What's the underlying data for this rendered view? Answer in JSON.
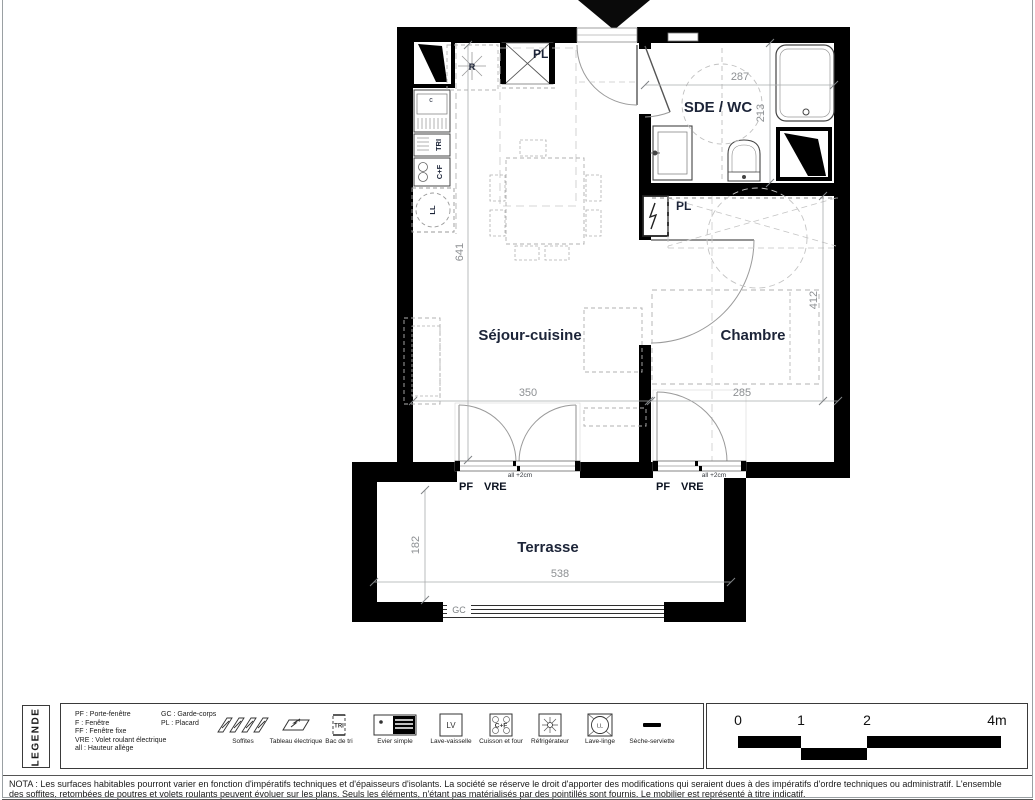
{
  "plan": {
    "rooms": {
      "sejour": {
        "label": "Séjour-cuisine",
        "dim_h": "641",
        "dim_w": "350"
      },
      "chambre": {
        "label": "Chambre",
        "dim_h": "412",
        "dim_w": "285"
      },
      "sde": {
        "label": "SDE / WC",
        "dim_w": "287",
        "dim_h": "213"
      },
      "terrasse": {
        "label": "Terrasse",
        "dim_h": "182",
        "dim_w": "538"
      }
    },
    "fixtures": {
      "refrigerateur": "R",
      "placard_entree": "PL",
      "placard_chambre": "PL",
      "bac_tri": "TRI",
      "cuisson_four": "C+F",
      "lave_linge": "LL",
      "evier": "c",
      "garde_corps": "GC"
    },
    "doors": {
      "sejour": {
        "pf": "PF",
        "vre": "VRE",
        "allege": "all +2cm"
      },
      "chambre": {
        "pf": "PF",
        "vre": "VRE",
        "allege": "all +2cm"
      }
    }
  },
  "legend": {
    "title": "LEGENDE",
    "abbr_col1": [
      "PF : Porte-fenêtre",
      "F : Fenêtre",
      "FF : Fenêtre fixe",
      "VRE : Volet roulant électrique",
      "all : Hauteur allège"
    ],
    "abbr_col2": [
      "GC : Garde-corps",
      "PL : Placard"
    ],
    "items": [
      {
        "label": "Soffites"
      },
      {
        "label": "Tableau électrique"
      },
      {
        "label": "Bac de tri"
      },
      {
        "label": "Evier simple"
      },
      {
        "label": "Lave-vaisselle"
      },
      {
        "label": "Cuisson et four"
      },
      {
        "label": "Réfrigérateur"
      },
      {
        "label": "Lave-linge"
      },
      {
        "label": "Sèche-serviette"
      }
    ],
    "icon_texts": {
      "tri": "TRI",
      "lv": "LV",
      "cf": "C+F",
      "ll": "LL"
    },
    "scale_ticks": [
      "0",
      "1",
      "2",
      "4m"
    ]
  },
  "nota": {
    "line1": "NOTA : Les surfaces habitables pourront varier en fonction d'impératifs techniques et d'épaisseurs d'isolants. La société se réserve le droit d'apporter des modifications qui seraient dues à des impératifs d'ordre techniques ou administratif. L'ensemble",
    "line2": "des soffites, retombées de poutres et volets roulants peuvent évoluer sur les plans. Seuls les éléments, n'étant pas matérialisés par des pointillés sont fournis. Le mobilier est représenté à titre indicatif."
  }
}
